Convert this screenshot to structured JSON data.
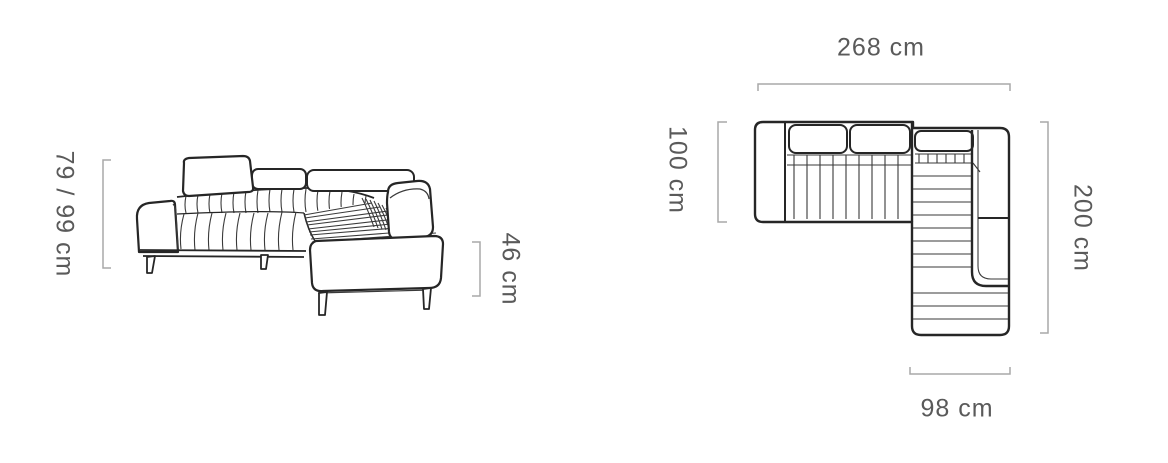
{
  "page": {
    "background_color": "#ffffff"
  },
  "diagram": {
    "subject": "Corner sofa with chaise — technical dimension drawing",
    "side_view": {
      "name": "perspective side view",
      "height": {
        "label": "79 / 99 cm"
      },
      "seat_height": {
        "label": "46 cm"
      }
    },
    "top_view": {
      "name": "top plan view",
      "total_width": {
        "label": "268 cm"
      },
      "section_depth": {
        "label": "100 cm"
      },
      "total_depth": {
        "label": "200 cm"
      },
      "chaise_width": {
        "label": "98 cm"
      }
    },
    "colors": {
      "outline": "#262626",
      "detail_line": "#3a3a3a",
      "dimension_line": "#a9a9a9",
      "dimension_text": "#5a5a5a"
    }
  }
}
